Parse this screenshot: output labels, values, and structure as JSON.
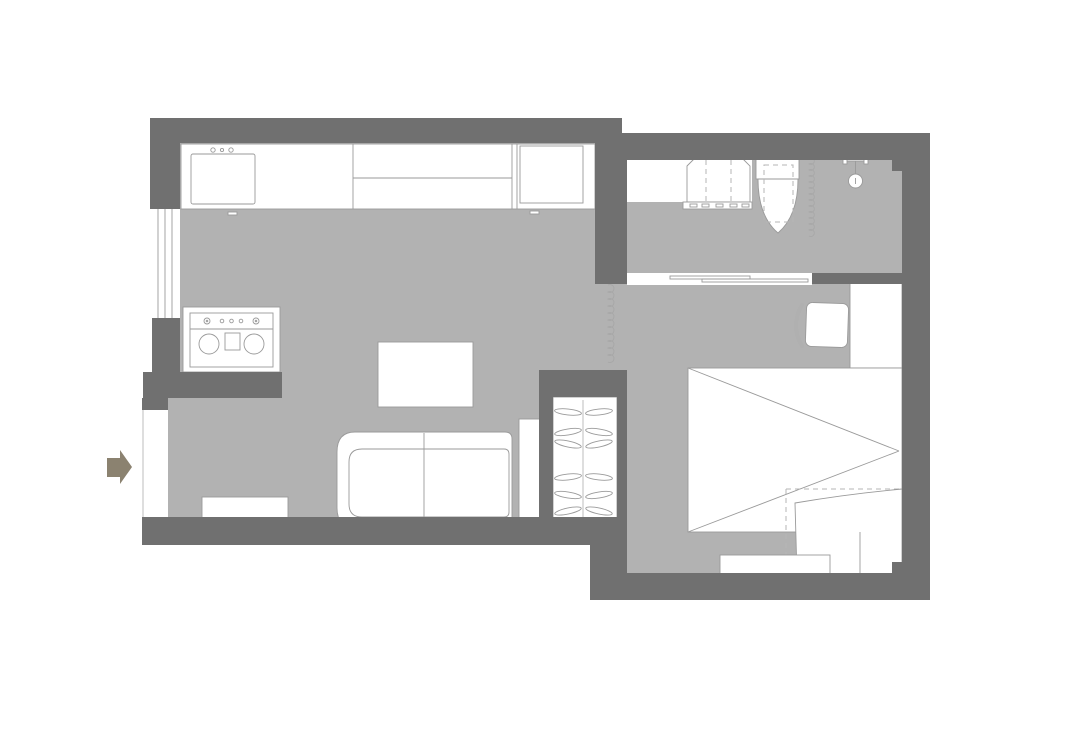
{
  "title": "studio-apartment-floor-plan",
  "colors": {
    "background": "#ffffff",
    "wall": "#707070",
    "floor": "#b2b2b2",
    "furniture_fill": "#ffffff",
    "furniture_stroke": "#9a9a9a",
    "detail_stroke": "#b5b5b5",
    "entry_arrow": "#8b8270"
  },
  "fixtures": [
    "entry-arrow",
    "entry-door-opening",
    "window",
    "kitchen-counter",
    "kitchen-sink",
    "faucet-dots",
    "refrigerator",
    "stove",
    "stove-burners",
    "coffee-table",
    "sofa",
    "tv-cabinet",
    "side-shelf",
    "wardrobe",
    "clothes-hangers",
    "room-divider-curtain",
    "bathroom-vanity-counter",
    "washing-machine",
    "toilet",
    "shower-curtain",
    "shower-fixture",
    "shower-head",
    "sliding-door",
    "desk",
    "desk-chair",
    "bed",
    "bed-foldout-panel",
    "bench"
  ],
  "wardrobe": {
    "hanger_rows": [
      412,
      432,
      444,
      477,
      495,
      511
    ]
  }
}
